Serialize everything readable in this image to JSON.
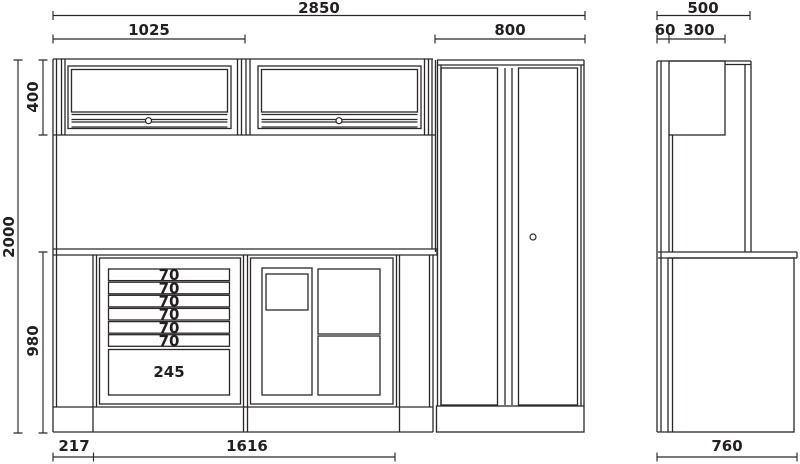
{
  "drawing": {
    "kind": "furniture dimensional drawing",
    "views": {
      "front": "front elevation",
      "side": "side elevation"
    }
  },
  "dimensions_mm": {
    "front": {
      "total_width": "2850",
      "wall_cabinet_width": "1025",
      "tall_cabinet_width": "800",
      "total_height": "2000",
      "wall_cabinet_height": "400",
      "base_height": "980",
      "base_left_offset": "217",
      "workbench_width": "1616",
      "drawer_heights": [
        "70",
        "70",
        "70",
        "70",
        "70",
        "70"
      ],
      "large_drawer_height": "245"
    },
    "side": {
      "total_depth": "500",
      "back_panel_depth": "60",
      "wall_cabinet_depth": "300",
      "workbench_depth": "760"
    }
  },
  "style": {
    "line_color": "#2b2728",
    "text_color": "#231f20",
    "background": "#ffffff"
  }
}
